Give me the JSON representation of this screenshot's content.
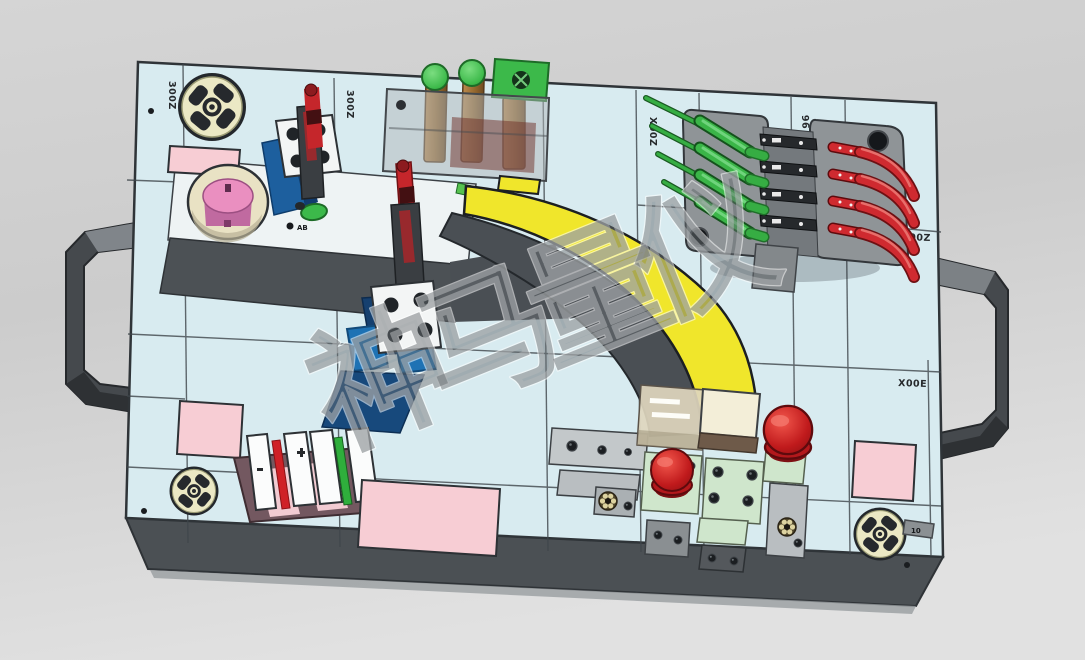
{
  "watermark": {
    "text": "神马量仪"
  },
  "plate_labels": {
    "top_left": "300Z",
    "clamp1_side": "300Z",
    "top_mid": "X00Z",
    "top_right": "96",
    "right_upper": "300Z",
    "right_mid": "X00E",
    "disc_tab": "10",
    "ab_mark": "AB"
  },
  "palette": {
    "background": "#d2d2d2",
    "plate_face": "#d8ebf0",
    "plate_edge": "#4b5054",
    "workpiece_yellow": "#f0e62b",
    "clamp_red": "#cf2a30",
    "clamp_green": "#3bb548",
    "locator_cream": "#ebe8c4",
    "pad_pink": "#f7cdd4",
    "base_blue": "#1e72b4",
    "base_navy": "#16406f",
    "pale_green_block": "#cfe6cc",
    "base_mauve": "#735860",
    "mushroom_red": "#c01a1c"
  }
}
